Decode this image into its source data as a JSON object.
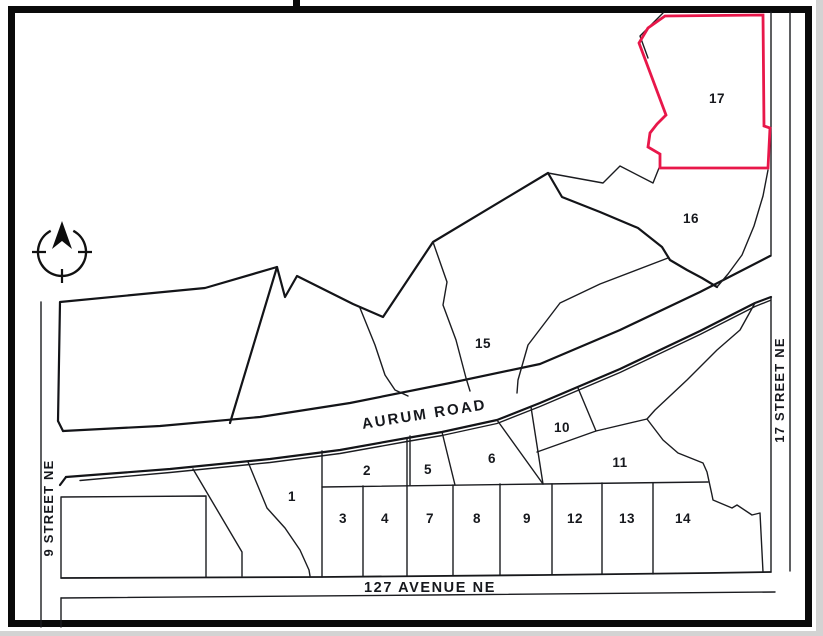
{
  "canvas": {
    "background": "#d3d3d3",
    "paper": "#ffffff",
    "frame_color": "#0a0a0a"
  },
  "map": {
    "line_color": "#1b1c20",
    "highlight_color": "#e8174a",
    "streets": {
      "aurum_road": "AURUM ROAD",
      "avenue_127": "127 AVENUE NE",
      "street_9": "9 STREET NE",
      "street_17": "17 STREET NE"
    },
    "parcel_labels": [
      "1",
      "2",
      "3",
      "4",
      "5",
      "6",
      "7",
      "8",
      "9",
      "10",
      "11",
      "12",
      "13",
      "14",
      "15",
      "16",
      "17"
    ],
    "highlighted_parcel_label": "17",
    "icons": {
      "compass": "compass-north-icon"
    }
  }
}
